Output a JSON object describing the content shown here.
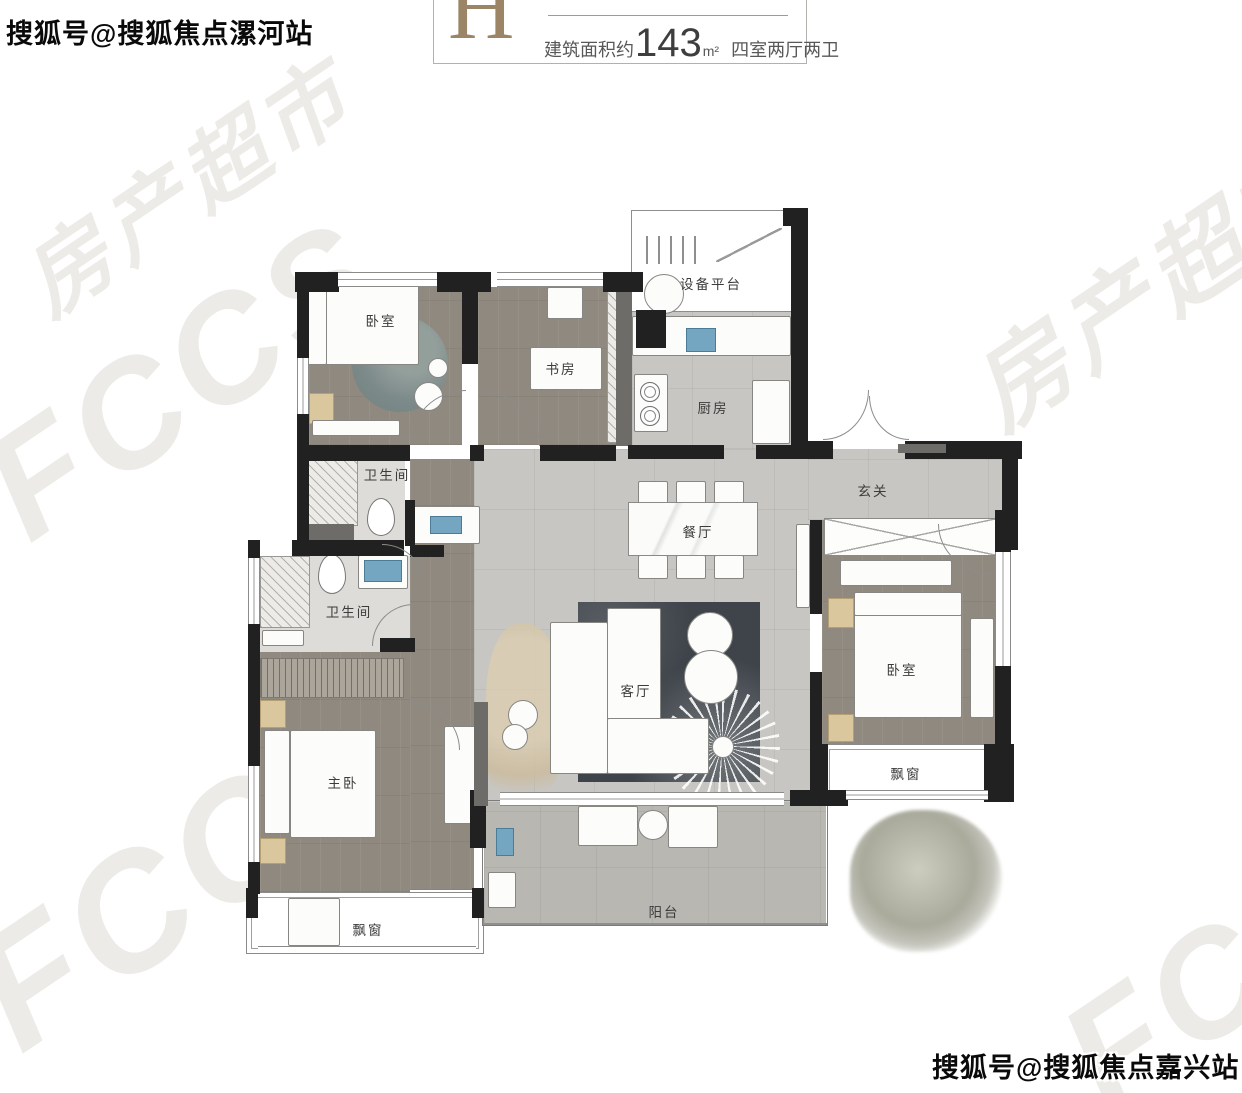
{
  "header": {
    "unit_letter": "H",
    "project_name_partial": "户型鉴赏",
    "area_prefix": "建筑面积约",
    "area_value": "143",
    "area_unit": "m²",
    "layout_spec": "四室两厅两卫"
  },
  "watermarks": {
    "top_left": "搜狐号@搜狐焦点漯河站",
    "bottom_right": "搜狐号@搜狐焦点嘉兴站",
    "faint_brand": "FCCS",
    "faint_brand_cn": "房产超市"
  },
  "rooms": {
    "bedroom_top_left": "卧室",
    "study": "书房",
    "equipment_platform": "设备平台",
    "kitchen": "厨房",
    "foyer": "玄关",
    "bathroom_upper": "卫生间",
    "dining_room": "餐厅",
    "bathroom_lower": "卫生间",
    "living_room": "客厅",
    "bedroom_right": "卧室",
    "master_bedroom": "主卧",
    "bay_window_right": "飘窗",
    "bay_window_bottom": "飘窗",
    "balcony": "阳台"
  },
  "colors": {
    "wall": "#212121",
    "wood_floor": "#90897f",
    "tile_floor": "#c8c6c2",
    "accent_tan": "#dbc79d",
    "sink_blue": "#74a5c1",
    "header_letter": "#9c8466"
  }
}
